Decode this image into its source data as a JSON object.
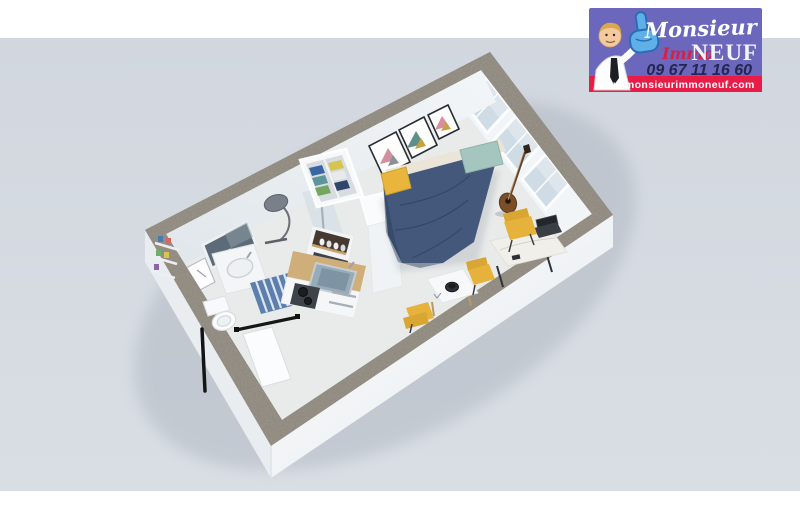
{
  "scene": {
    "background_color": "#d3d8e0",
    "band_color": "#ffffff"
  },
  "logo": {
    "brand_top": "Monsieur",
    "brand_immo": "Immo",
    "brand_neuf": "NEUF",
    "phone": "09 67 11 16 60",
    "website": "www.monsieurimmoneuf.com",
    "colors": {
      "background": "#6b67bd",
      "banner": "#e81c47",
      "phone_text": "#232750",
      "brand_top_text": "#ffffff",
      "immo_text": "#d5204a",
      "neuf_text": "#f4f4f8",
      "website_text": "#ffffff",
      "foam_hand": "#5fb0e6",
      "skin": "#f4c99e",
      "hair": "#d8a84e"
    }
  },
  "plan": {
    "colors": {
      "wall_top": "#8f897f",
      "wall_face": "#f5f7f8",
      "wall_face_shade": "#e9edf0",
      "floor": "#e7e9e8",
      "bed_duvet": "#44587b",
      "mattress": "#ebe5d8",
      "pillow_teal": "#a5c6bf",
      "cushion_yellow": "#e9b53d",
      "chair_yellow": "#e7b23c",
      "mat_blue": "#5c7fae",
      "window_glass": "#cfdce5",
      "mirror": "#5d6b78",
      "counter_wood": "#cfae79",
      "sink_basin": "#97abb9",
      "appliance_dark": "#3e434a",
      "guitar_brown": "#7a4f28",
      "clothes": [
        "#3a67a4",
        "#5e949b",
        "#74a662",
        "#d6c44e",
        "#e8eaec",
        "#31466b"
      ]
    }
  }
}
